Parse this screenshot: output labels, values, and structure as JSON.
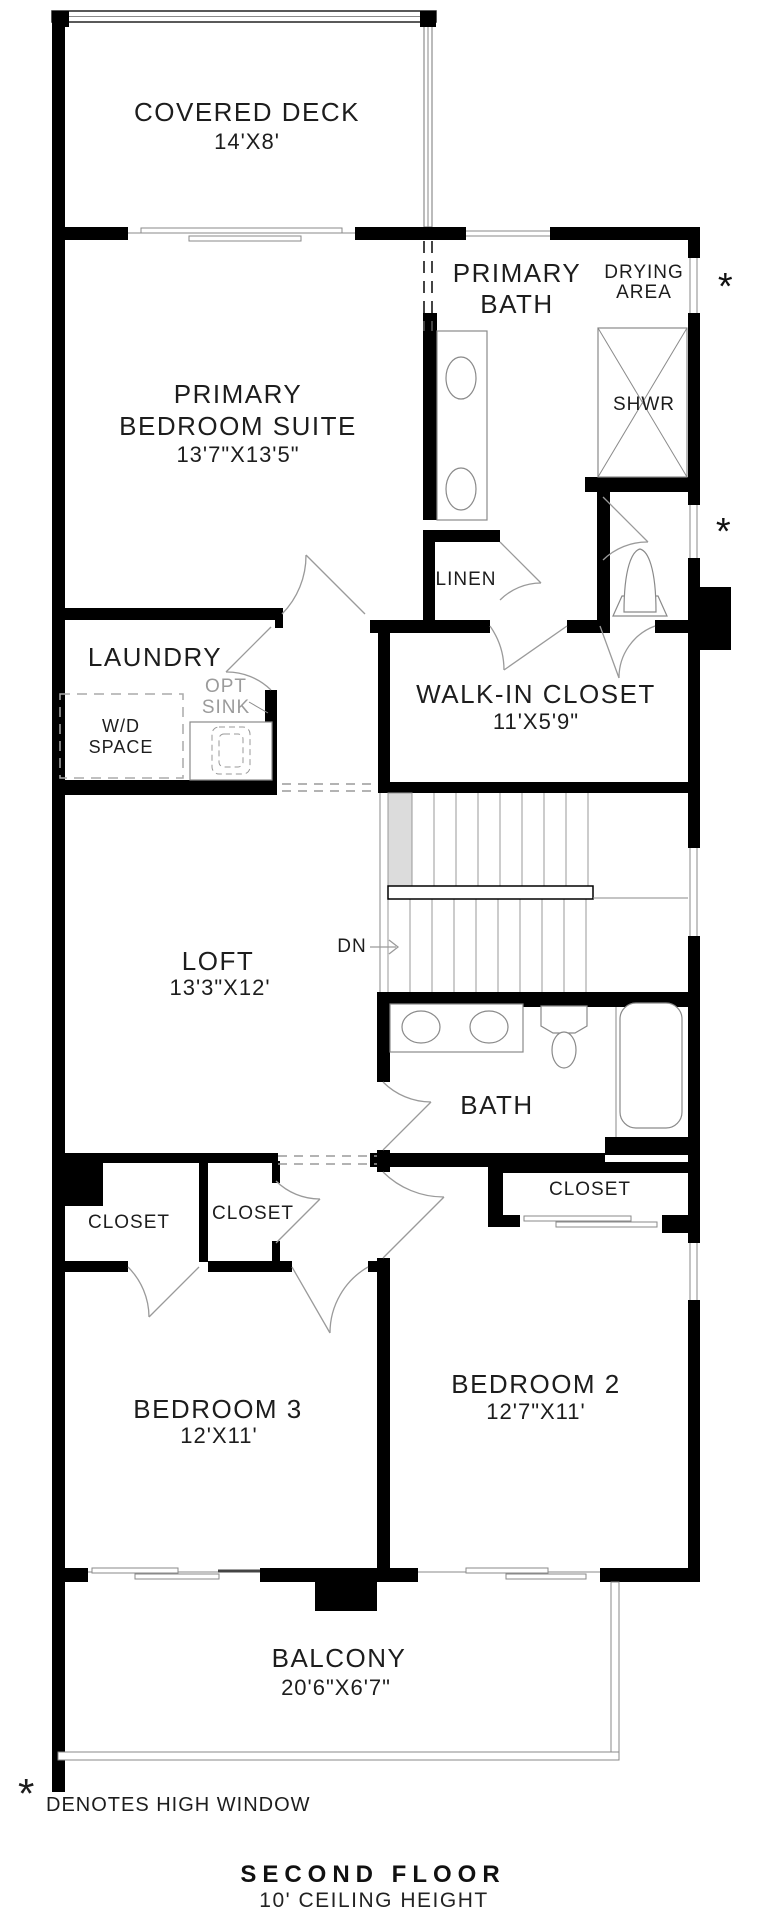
{
  "meta": {
    "floor_title": "SECOND FLOOR",
    "floor_subtitle": "10' CEILING HEIGHT",
    "legend_symbol": "*",
    "legend_text": "DENOTES HIGH WINDOW"
  },
  "annotations": {
    "high_window_marker": "*",
    "stair_direction": "DN"
  },
  "rooms": {
    "covered_deck": {
      "name": "COVERED DECK",
      "dims": "14'X8'"
    },
    "primary_bedroom": {
      "name_line1": "PRIMARY",
      "name_line2": "BEDROOM SUITE",
      "dims": "13'7\"X13'5\""
    },
    "primary_bath": {
      "name_line1": "PRIMARY",
      "name_line2": "BATH"
    },
    "drying_area": {
      "name_line1": "DRYING",
      "name_line2": "AREA"
    },
    "shower": {
      "name": "SHWR"
    },
    "linen": {
      "name": "LINEN"
    },
    "laundry": {
      "name": "LAUNDRY",
      "opt_sink_line1": "OPT",
      "opt_sink_line2": "SINK",
      "wd_line1": "W/D",
      "wd_line2": "SPACE"
    },
    "walk_in_closet": {
      "name": "WALK-IN CLOSET",
      "dims": "11'X5'9\""
    },
    "loft": {
      "name": "LOFT",
      "dims": "13'3\"X12'"
    },
    "bath": {
      "name": "BATH"
    },
    "bedroom2_closet": {
      "name": "CLOSET"
    },
    "bedroom3_closet1": {
      "name": "CLOSET"
    },
    "bedroom3_closet2": {
      "name": "CLOSET"
    },
    "bedroom3": {
      "name": "BEDROOM 3",
      "dims": "12'X11'"
    },
    "bedroom2": {
      "name": "BEDROOM 2",
      "dims": "12'7\"X11'"
    },
    "balcony": {
      "name": "BALCONY",
      "dims": "20'6\"X6'7\""
    }
  },
  "colors": {
    "wall": "#000000",
    "line": "#8a8a8a",
    "muted_text": "#9b9b9b",
    "text": "#1d1d1d",
    "stair_tread": "#dcdcdc"
  }
}
